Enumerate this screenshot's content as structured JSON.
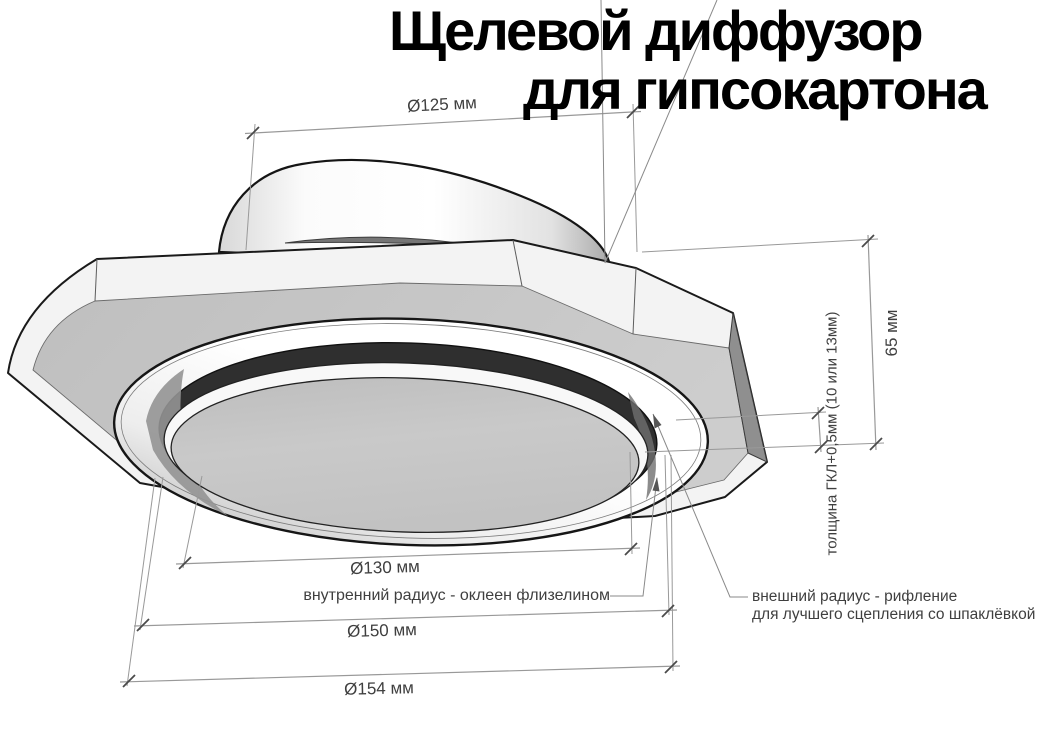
{
  "title": {
    "line1": "Щелевой диффузор",
    "line2": "для гипсокартона"
  },
  "dimensions": {
    "dia125": {
      "label": "Ø125 мм"
    },
    "height65": {
      "label": "65 мм"
    },
    "gkl_thickness": {
      "label": "толщина ГКЛ+0,5мм (10 или 13мм)"
    },
    "dia130": {
      "label": "Ø130 мм"
    },
    "dia150": {
      "label": "Ø150 мм"
    },
    "dia154": {
      "label": "Ø154 мм"
    }
  },
  "annotations": {
    "inner_radius": {
      "text": "внутренний радиус - оклеен флизелином"
    },
    "outer_radius": {
      "line1": "внешний радиус - рифление",
      "line2": "для лучшего сцепления со шпаклёвкой"
    }
  },
  "colors": {
    "background": "#ffffff",
    "plate_face": "#c5c5c5",
    "plate_side_shadow": "#8f8f8f",
    "bevel_highlight": "#f3f3f3",
    "slot_ring": "#2f2f2f",
    "inner_disc": "#c7c7c7",
    "dimension_line": "#999999",
    "dimension_text": "#3f3f3f",
    "title_text": "#000000"
  }
}
